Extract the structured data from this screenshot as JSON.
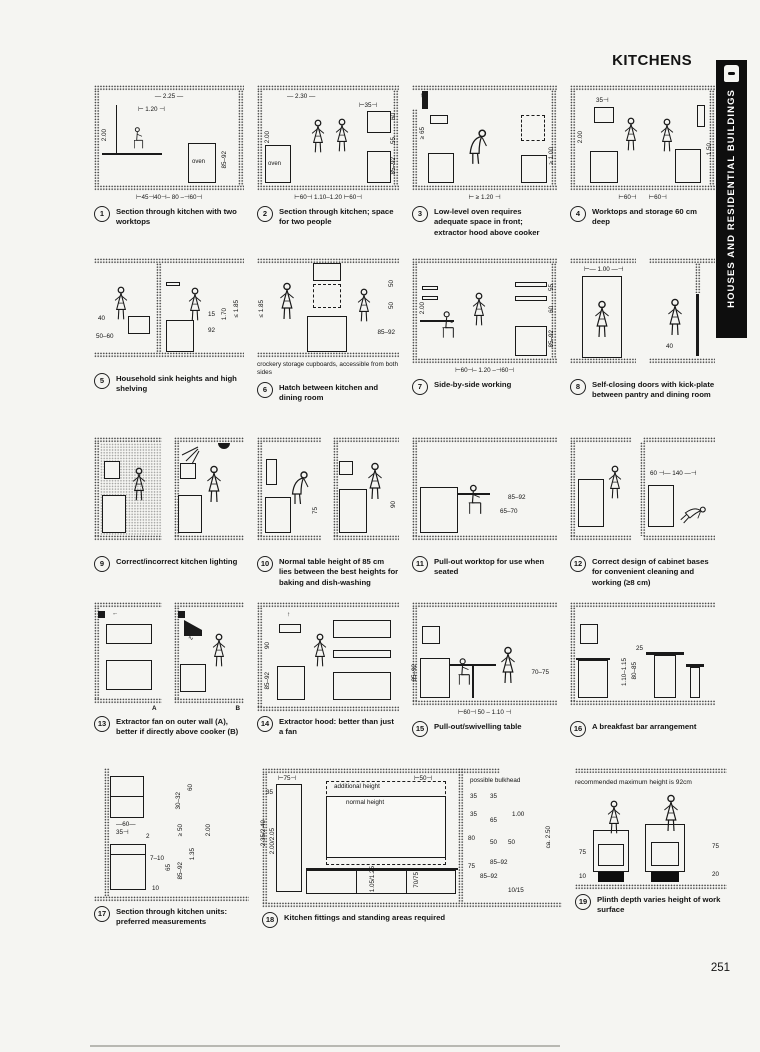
{
  "header": {
    "title": "KITCHENS",
    "chapter": "HOUSES AND RESIDENTIAL BUILDINGS"
  },
  "footer": {
    "page_number": "251"
  },
  "icons": {
    "up": "↑",
    "left": "←",
    "steam": "∿"
  },
  "figures": [
    {
      "num": "1",
      "caption": "Section through kitchen with two worktops",
      "dims": {
        "top": "— 2.25 —",
        "mid": "⊢ 1.20 ⊣",
        "h": "2.00",
        "worktop": "85–92",
        "oven": "oven",
        "bottom": "⊢45⊣40⊣– 80 –⊣60⊣"
      }
    },
    {
      "num": "2",
      "caption": "Section through kitchen; space for two people",
      "dims": {
        "top": "— 2.30 —",
        "shelf": "⊢35⊣",
        "s1": "60",
        "s2": "55",
        "h": "2.00",
        "worktop": "85–92",
        "oven": "oven",
        "bottom": "⊢60⊣ 1.10–1.20 ⊢60⊣"
      }
    },
    {
      "num": "3",
      "caption": "Low-level oven requires adequate space in front; extractor hood above cooker",
      "dims": {
        "hood": "≥ 65",
        "right": "≥ 1.00",
        "bottom": "⊢ ≥ 1.20 ⊣"
      }
    },
    {
      "num": "4",
      "caption": "Worktops and storage 60 cm deep",
      "dims": {
        "shelf": "35⊣",
        "h": "2.00",
        "reach": "1.50",
        "b1": "⊢60⊣",
        "b2": "⊢60⊣"
      }
    },
    {
      "num": "5",
      "caption": "Household sink heights and high shelving",
      "dims": {
        "a": "40",
        "b": "50–60",
        "c": "15",
        "d": "92",
        "e": "1.70",
        "f": "≤ 1.85"
      }
    },
    {
      "num": "6",
      "caption": "Hatch between kitchen and dining room",
      "note": "crockery storage cupboards, accessible from both sides",
      "dims": {
        "left": "≤ 1.85",
        "t1": "50",
        "t2": "50",
        "worktop": "85–92"
      }
    },
    {
      "num": "7",
      "caption": "Side-by-side working",
      "dims": {
        "h": "2.00",
        "s1": "55",
        "s2": "60",
        "worktop": "85–92",
        "bottom": "⊢60⊣– 1.20 –⊣60⊣"
      }
    },
    {
      "num": "8",
      "caption": "Self-closing doors with kick-plate between pantry and dining room",
      "dims": {
        "door": "⊢— 1.00 —⊣",
        "kick": "40"
      }
    },
    {
      "num": "9",
      "caption": "Correct/incorrect kitchen lighting",
      "dims": {}
    },
    {
      "num": "10",
      "caption": "Normal table height of 85 cm lies between the best heights for baking and dish-washing",
      "dims": {
        "bake": "75",
        "wash": "90"
      }
    },
    {
      "num": "11",
      "caption": "Pull-out worktop for use when seated",
      "dims": {
        "worktop": "85–92",
        "pull": "65–70"
      }
    },
    {
      "num": "12",
      "caption": "Correct design of cabinet bases for convenient cleaning and working (≥8 cm)",
      "dims": {
        "span": "60 ⊣— 140 —⊣"
      }
    },
    {
      "num": "13",
      "caption": "Extractor fan on outer wall (A), better if directly above cooker (B)",
      "labels": {
        "a": "A",
        "b": "B"
      }
    },
    {
      "num": "14",
      "caption": "Extractor hood: better than just a fan",
      "dims": {
        "hood": "90",
        "worktop": "85–92"
      }
    },
    {
      "num": "15",
      "caption": "Pull-out/swivelling table",
      "dims": {
        "worktop": "85–92",
        "table": "70–75",
        "bottom": "⊢60⊣ 50 – 1.10 ⊣"
      }
    },
    {
      "num": "16",
      "caption": "A breakfast bar arrangement",
      "dims": {
        "bar": "1.10–1.15",
        "stool": "80–85",
        "diff": "25"
      }
    },
    {
      "num": "17",
      "caption": "Section through kitchen units: preferred measurements",
      "dims": {
        "cup": "—60—",
        "shelf": "35⊣",
        "gap": "2",
        "v1": "30–32",
        "v2": "60",
        "v3": "≥ 50",
        "v4": "1.35",
        "v5": "2.00",
        "drawer": "7–10",
        "v6": "65",
        "v7": "85–92",
        "plinth": "10"
      }
    },
    {
      "num": "18",
      "caption": "Kitchen fittings and standing areas required",
      "labels": {
        "add": "additional height",
        "normal": "normal height",
        "bulk": "possible bulkhead"
      },
      "dims": {
        "t1": "⊢75⊣",
        "t2": "⊢50⊣",
        "l1": "35",
        "lv1": "2.35/2.40",
        "lv2": "2.00/2.05",
        "cv1": "1.05/1.25",
        "cv2": "70/75",
        "s1": "35",
        "s2": "35",
        "s3": "35",
        "s4": "65",
        "s5": "1.00",
        "s6": "80",
        "s7": "50",
        "s8": "50",
        "s9": "75",
        "s10": "85–92",
        "s11": "85–92",
        "s12": "10/15",
        "s13": "ca. 2.50"
      }
    },
    {
      "num": "19",
      "caption": "Plinth depth varies height of work surface",
      "note": "recommended maximum height is 92cm",
      "dims": {
        "l1": "75",
        "l2": "10",
        "r1": "75",
        "r2": "20"
      }
    }
  ]
}
